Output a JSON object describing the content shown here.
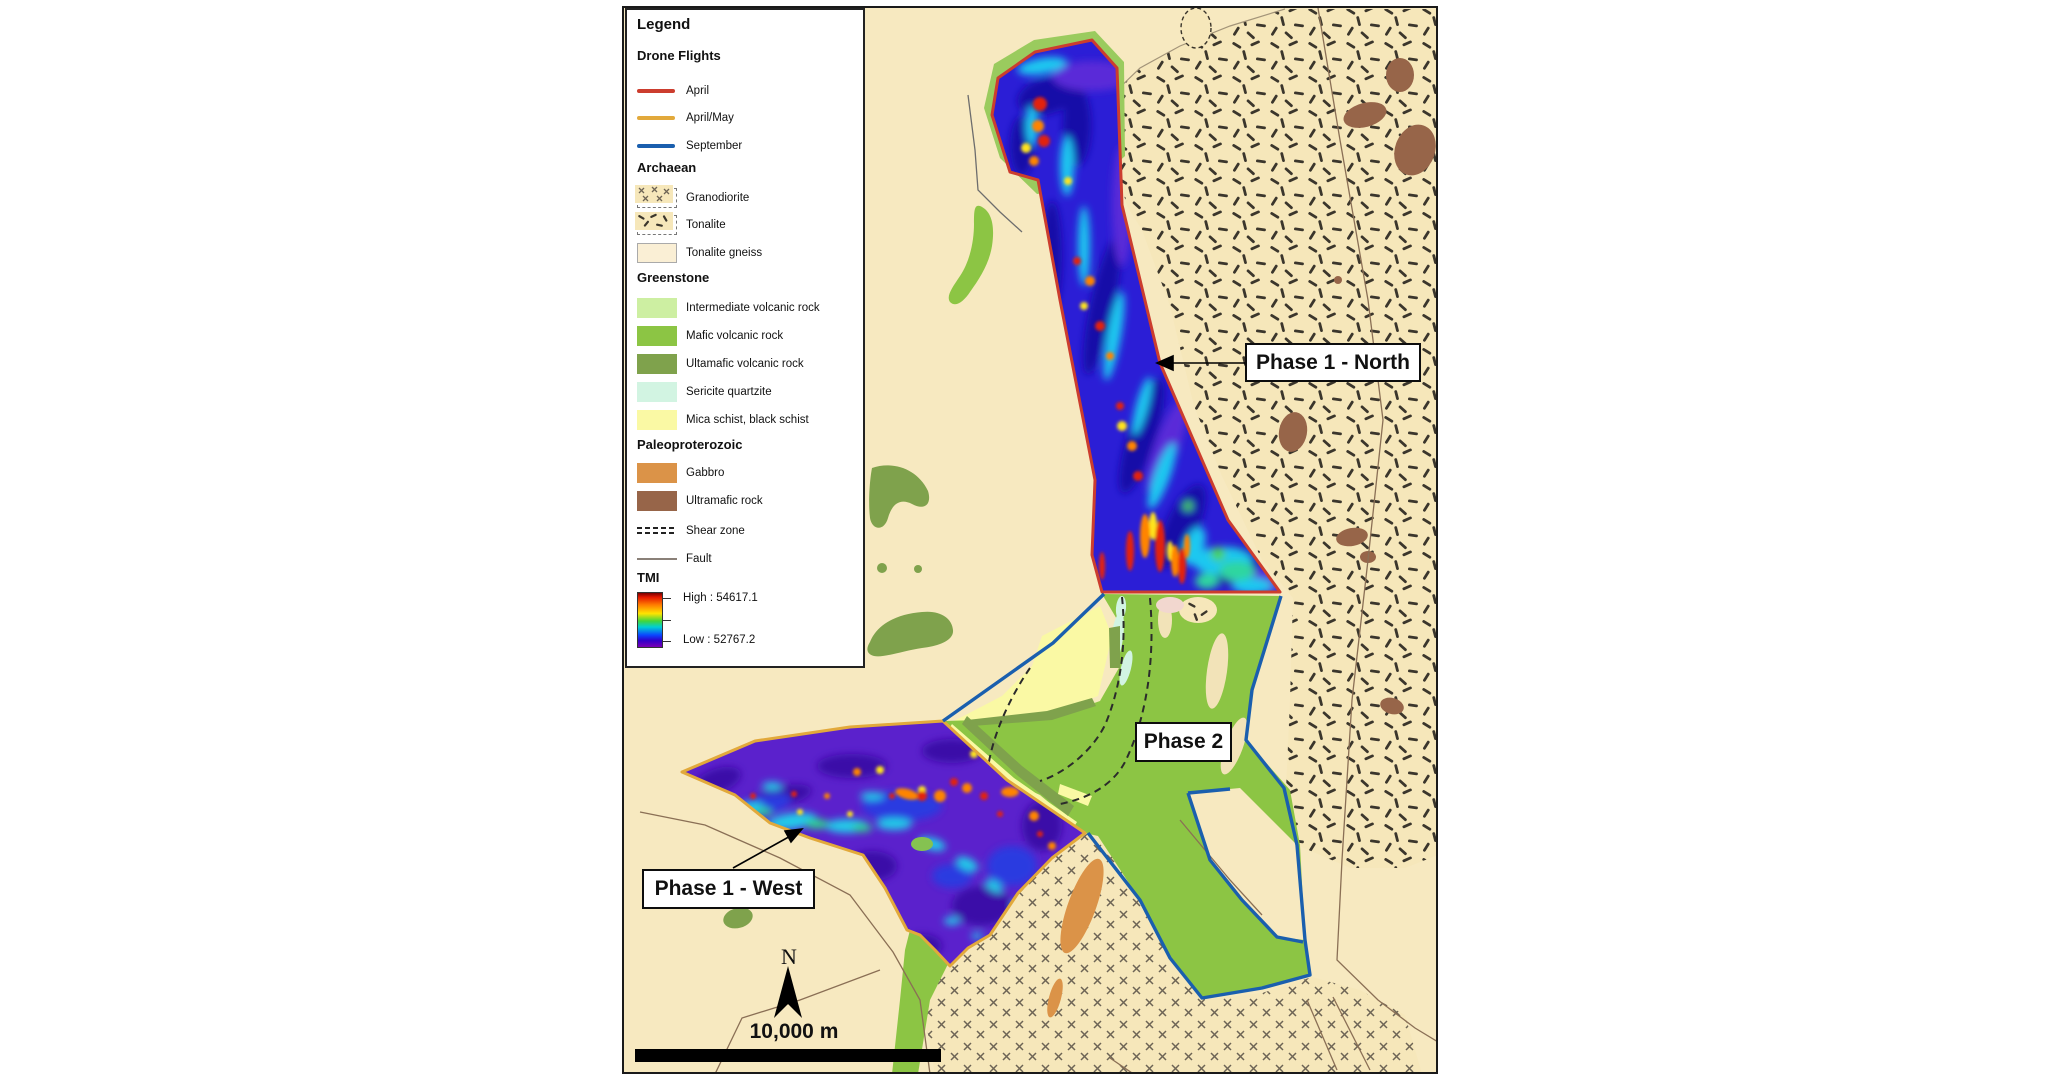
{
  "legend": {
    "title": "Legend",
    "drone_heading": "Drone Flights",
    "drone_items": [
      {
        "label": "April",
        "color": "#CC3D2E"
      },
      {
        "label": "April/May",
        "color": "#E2A93B"
      },
      {
        "label": "September",
        "color": "#1A5FAE"
      }
    ],
    "archaean_heading": "Archaean",
    "archaean_items": [
      {
        "label": "Granodiorite"
      },
      {
        "label": "Tonalite"
      },
      {
        "label": "Tonalite gneiss",
        "color": "#FAEFD5"
      }
    ],
    "greenstone_heading": "Greenstone",
    "greenstone_items": [
      {
        "label": "Intermediate volcanic rock",
        "color": "#CDEFA2"
      },
      {
        "label": "Mafic volcanic rock",
        "color": "#8CC544"
      },
      {
        "label": "Ultamafic volcanic rock",
        "color": "#7FA24C"
      },
      {
        "label": "Sericite quartzite",
        "color": "#D2F4E2"
      },
      {
        "label": "Mica schist, black schist",
        "color": "#FAF9A4"
      }
    ],
    "paleo_heading": "Paleoproterozoic",
    "paleo_items": [
      {
        "label": "Gabbro",
        "color": "#DB9348"
      },
      {
        "label": "Ultramafic rock",
        "color": "#976549"
      }
    ],
    "line_items": [
      {
        "label": "Shear zone"
      },
      {
        "label": "Fault"
      }
    ],
    "tmi_heading": "TMI",
    "tmi_high": "High : 54617.1",
    "tmi_low": "Low : 52767.2"
  },
  "map": {
    "annotations": {
      "phase1_north": "Phase 1 - North",
      "phase2": "Phase 2",
      "phase1_west": "Phase 1 - West"
    },
    "north_label": "N",
    "scale_text": "10,000 m"
  }
}
